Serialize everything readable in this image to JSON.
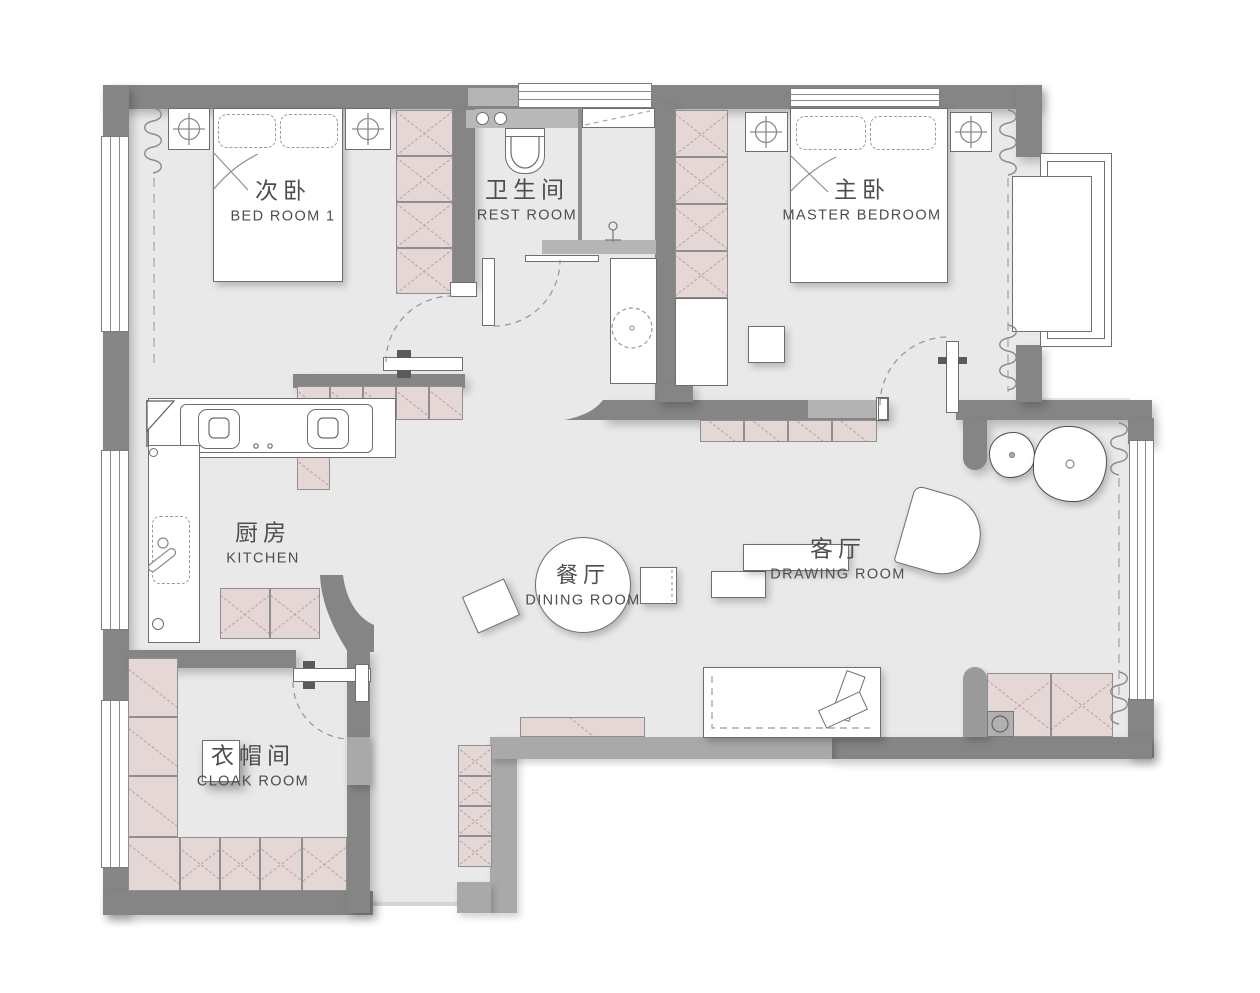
{
  "rooms": [
    {
      "id": "bedroom1",
      "zh": "次卧",
      "en": "BED ROOM 1"
    },
    {
      "id": "restroom",
      "zh": "卫生间",
      "en": "REST ROOM"
    },
    {
      "id": "master-bedroom",
      "zh": "主卧",
      "en": "MASTER BEDROOM"
    },
    {
      "id": "kitchen",
      "zh": "厨房",
      "en": "KITCHEN"
    },
    {
      "id": "dining-room",
      "zh": "餐厅",
      "en": "DINING ROOM"
    },
    {
      "id": "drawing-room",
      "zh": "客厅",
      "en": "DRAWING ROOM"
    },
    {
      "id": "cloak-room",
      "zh": "衣帽间",
      "en": "CLOAK ROOM"
    }
  ],
  "colors": {
    "wall": "#858585",
    "wall_light": "#a9a9a9",
    "floor": "#e9e9e9",
    "cabinet": "#e4d7d5",
    "cabinet_hatch": "#b4a2a0",
    "outline": "#6e6e6e",
    "text": "#4e4e4e"
  }
}
